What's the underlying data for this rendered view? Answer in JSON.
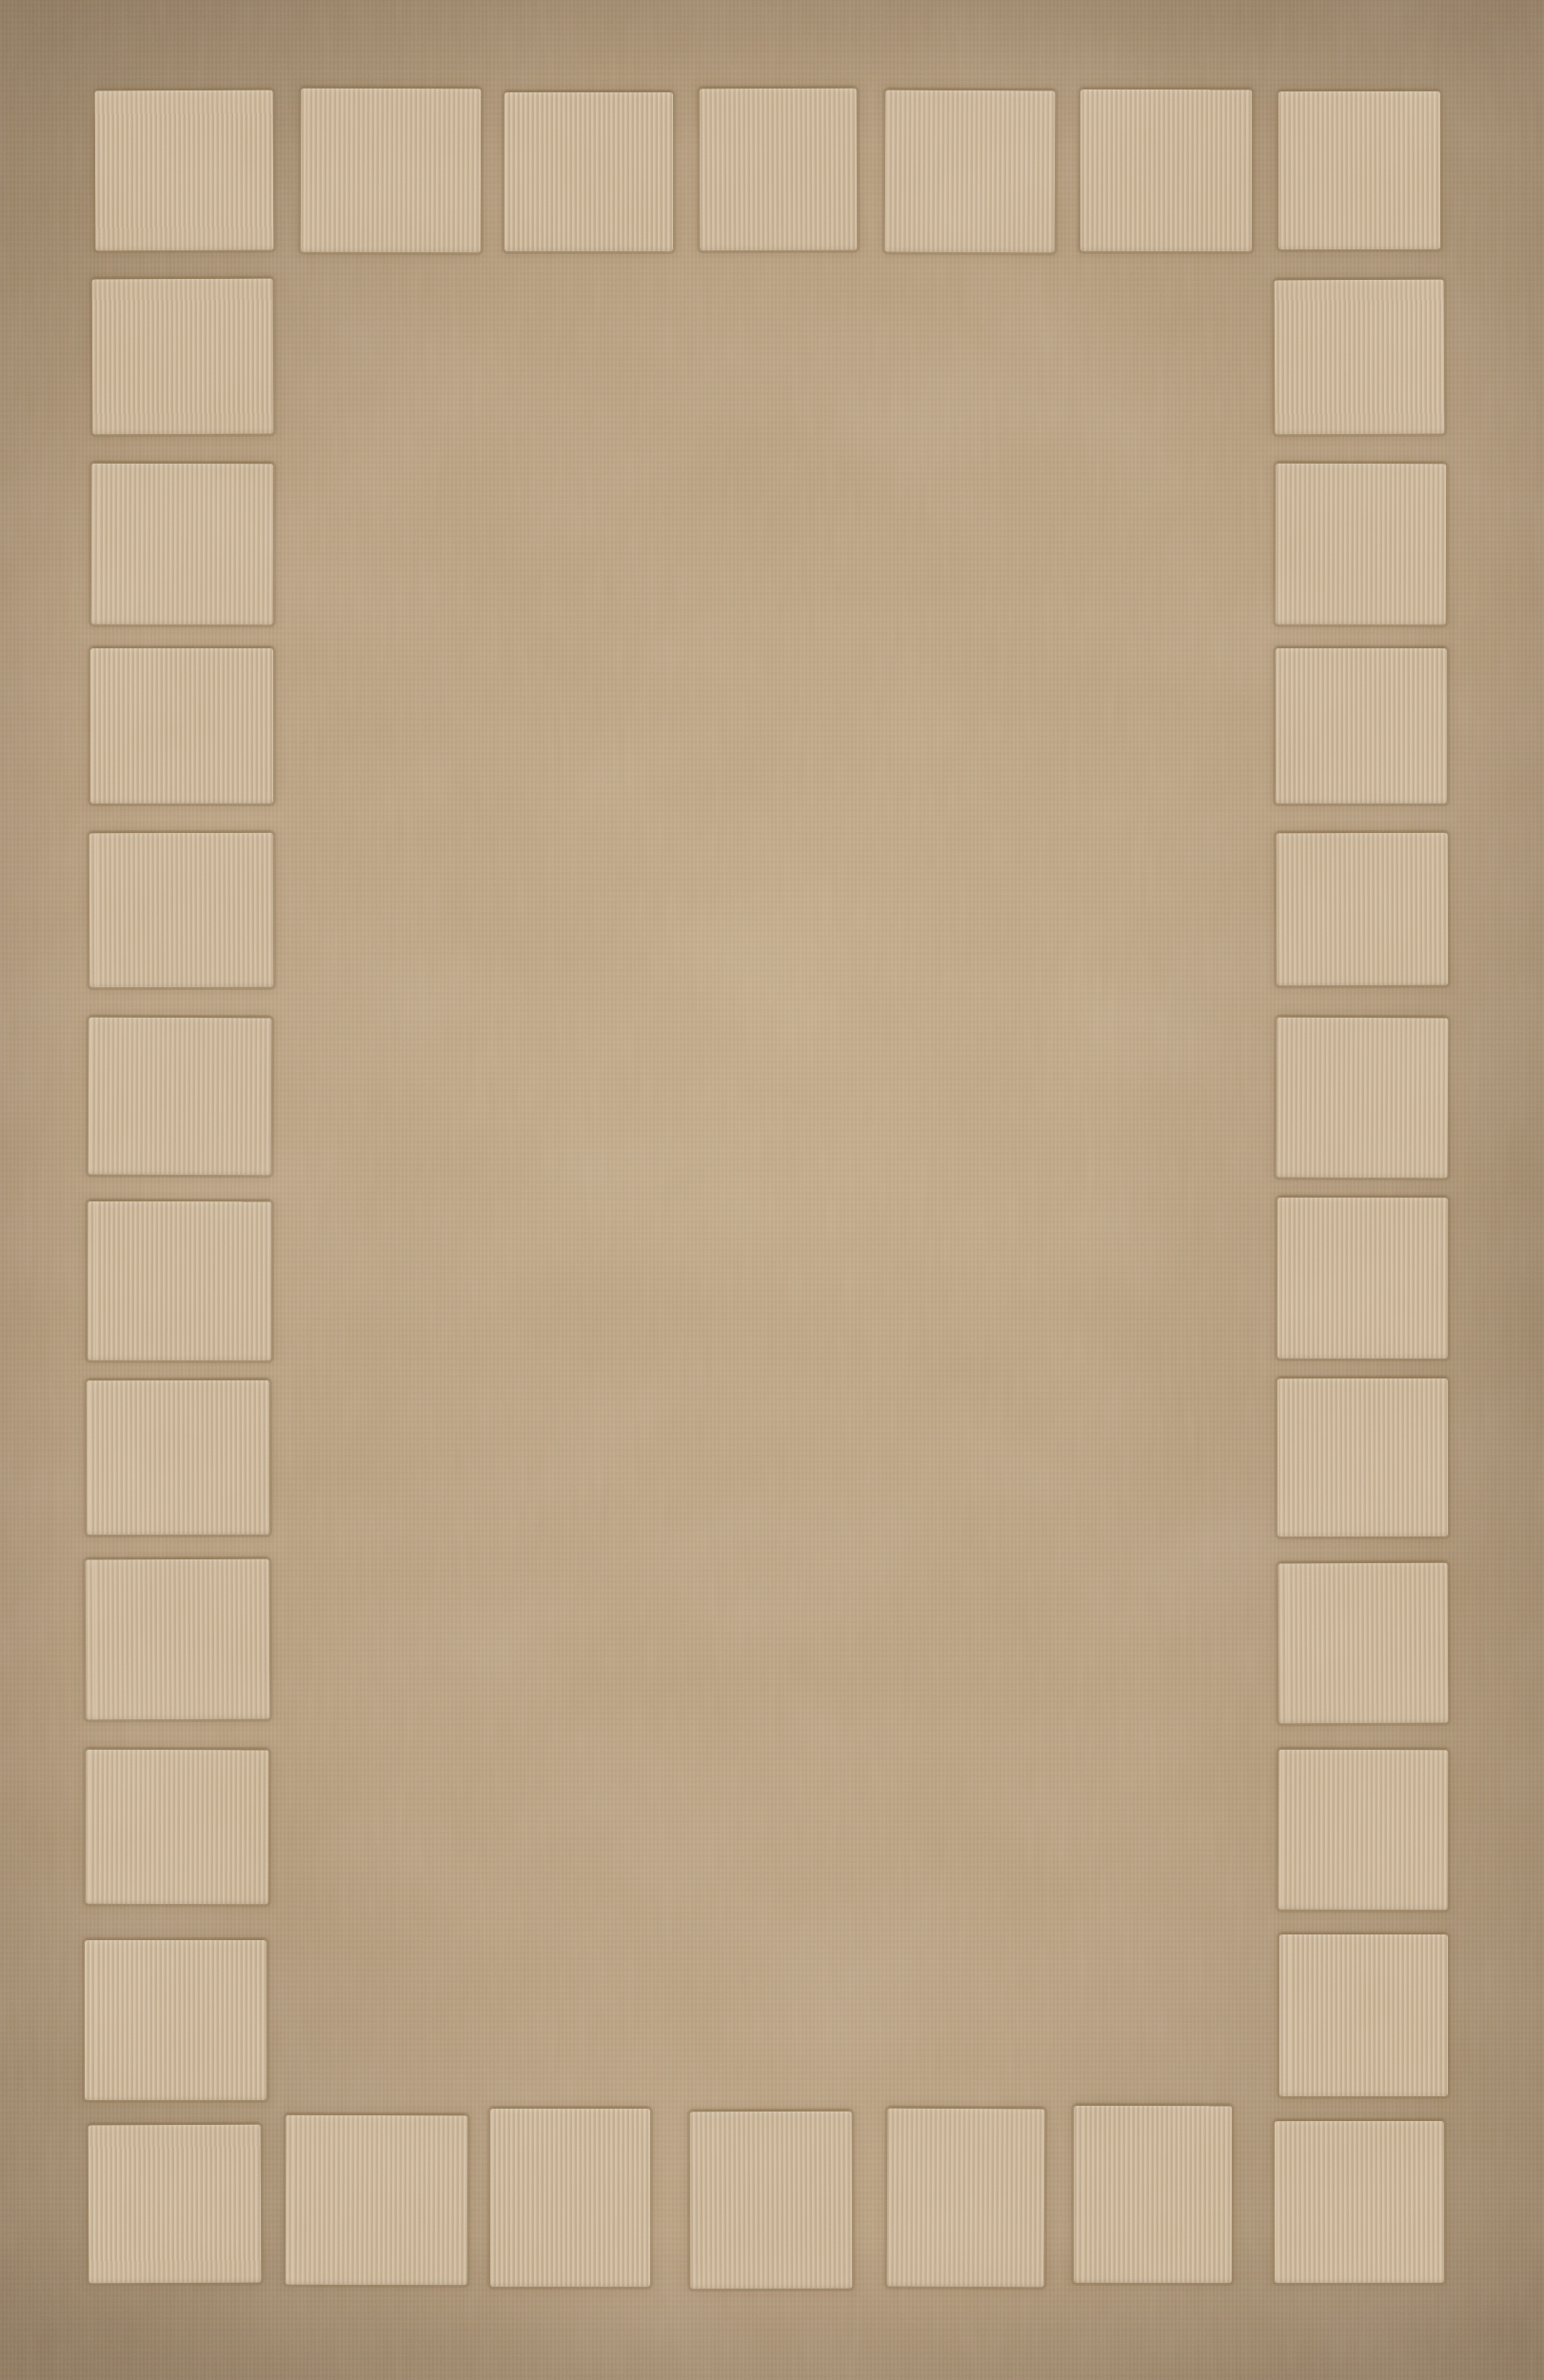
{
  "image": {
    "kind": "photograph",
    "subject": "beige hand-tufted wool area rug",
    "description": "Top-down product photo of a rectangular taupe-beige area rug. A border of raised, carved lighter-beige squares runs around the entire perimeter; the large center field and outer margin are plain tan pile. The rug fills the whole frame.",
    "orientation": "portrait",
    "visible_text": ""
  },
  "palette": {
    "field_base": "#b19776",
    "field_highlight": "#c2a785",
    "field_shadow": "#9c8569",
    "square_fill": "#c7b091",
    "square_rib_light": "#d2bc9e",
    "square_rib_dark": "#bca687",
    "groove": "#8a7051",
    "grain": "#6b573f"
  },
  "pattern": {
    "style": "carved square-block border",
    "square_count_total": 34,
    "counts": {
      "top_row": 7,
      "bottom_row": 7,
      "left_column_total": 12,
      "right_column_total": 12,
      "corners_shared": true
    },
    "squares": {
      "top_row": [
        [
          100,
          95,
          187,
          168
        ],
        [
          316,
          93,
          189,
          172
        ],
        [
          530,
          97,
          177,
          167
        ],
        [
          735,
          93,
          165,
          170
        ],
        [
          930,
          95,
          178,
          170
        ],
        [
          1135,
          94,
          180,
          170
        ],
        [
          1343,
          96,
          170,
          166
        ]
      ],
      "left_column": [
        [
          97,
          293,
          190,
          163
        ],
        [
          96,
          487,
          191,
          169
        ],
        [
          95,
          681,
          192,
          163
        ],
        [
          94,
          875,
          193,
          162
        ],
        [
          93,
          1069,
          192,
          165
        ],
        [
          92,
          1262,
          193,
          167
        ],
        [
          91,
          1450,
          192,
          162
        ],
        [
          90,
          1638,
          193,
          168
        ],
        [
          90,
          1838,
          192,
          162
        ],
        [
          89,
          2038,
          191,
          168
        ]
      ],
      "right_column": [
        [
          1339,
          294,
          178,
          162
        ],
        [
          1340,
          487,
          179,
          169
        ],
        [
          1340,
          681,
          180,
          163
        ],
        [
          1341,
          875,
          180,
          160
        ],
        [
          1341,
          1069,
          180,
          168
        ],
        [
          1342,
          1258,
          179,
          169
        ],
        [
          1342,
          1448,
          179,
          166
        ],
        [
          1343,
          1642,
          178,
          168
        ],
        [
          1343,
          1838,
          178,
          168
        ],
        [
          1344,
          2032,
          177,
          170
        ]
      ],
      "bottom_row": [
        [
          93,
          2232,
          181,
          166
        ],
        [
          300,
          2222,
          191,
          178
        ],
        [
          515,
          2215,
          168,
          187
        ],
        [
          725,
          2218,
          170,
          186
        ],
        [
          932,
          2215,
          165,
          187
        ],
        [
          1128,
          2212,
          166,
          186
        ],
        [
          1339,
          2228,
          178,
          170
        ]
      ]
    }
  }
}
